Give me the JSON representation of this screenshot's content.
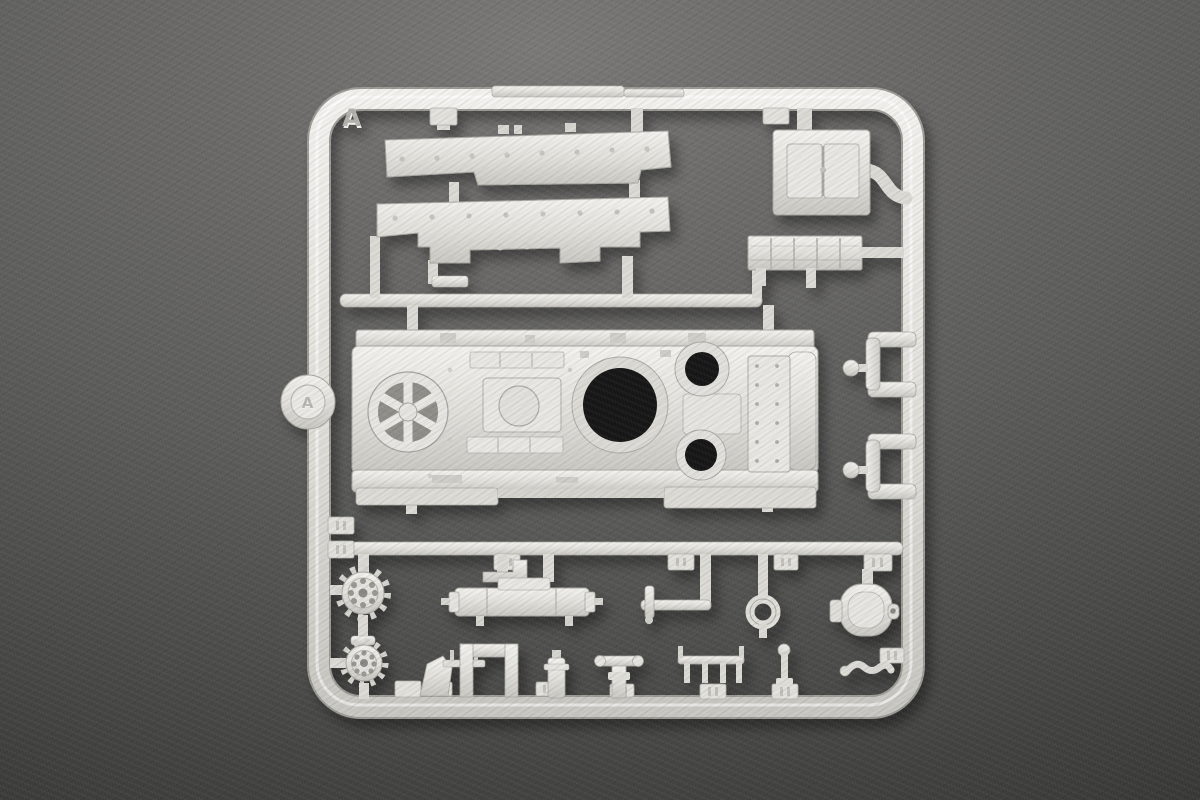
{
  "scene": {
    "kind": "photograph",
    "subject": "plastic scale-model kit sprue (runner) with tank-hull parts lying on dark gray felt"
  },
  "sprue": {
    "frame_letter": "A",
    "disc_letter": "A",
    "colors": {
      "plastic_light": "#f2f1ed",
      "plastic_mid": "#dcdbd6",
      "plastic_edge": "#a9a8a2",
      "recess_gray": "#93928c",
      "opening_black": "#171512",
      "background_center": "#6e6d6c",
      "background_corner": "#323231"
    },
    "parts_depicted": [
      "upper fender strip",
      "lower fender strip with notches",
      "engine access hatch box",
      "slatted vent grille",
      "main upper hull with turret ring and two round openings",
      "spoked idler fan wheel",
      "round sprue disc",
      "two C-shaped clamp brackets",
      "two toothed sprocket wheels",
      "muffler with mounting bracket",
      "crank axle",
      "towing eye ring",
      "round cap drum",
      "periscope T-handle",
      "pin rack",
      "ball-top post",
      "small fittings and blank number tabs"
    ]
  }
}
